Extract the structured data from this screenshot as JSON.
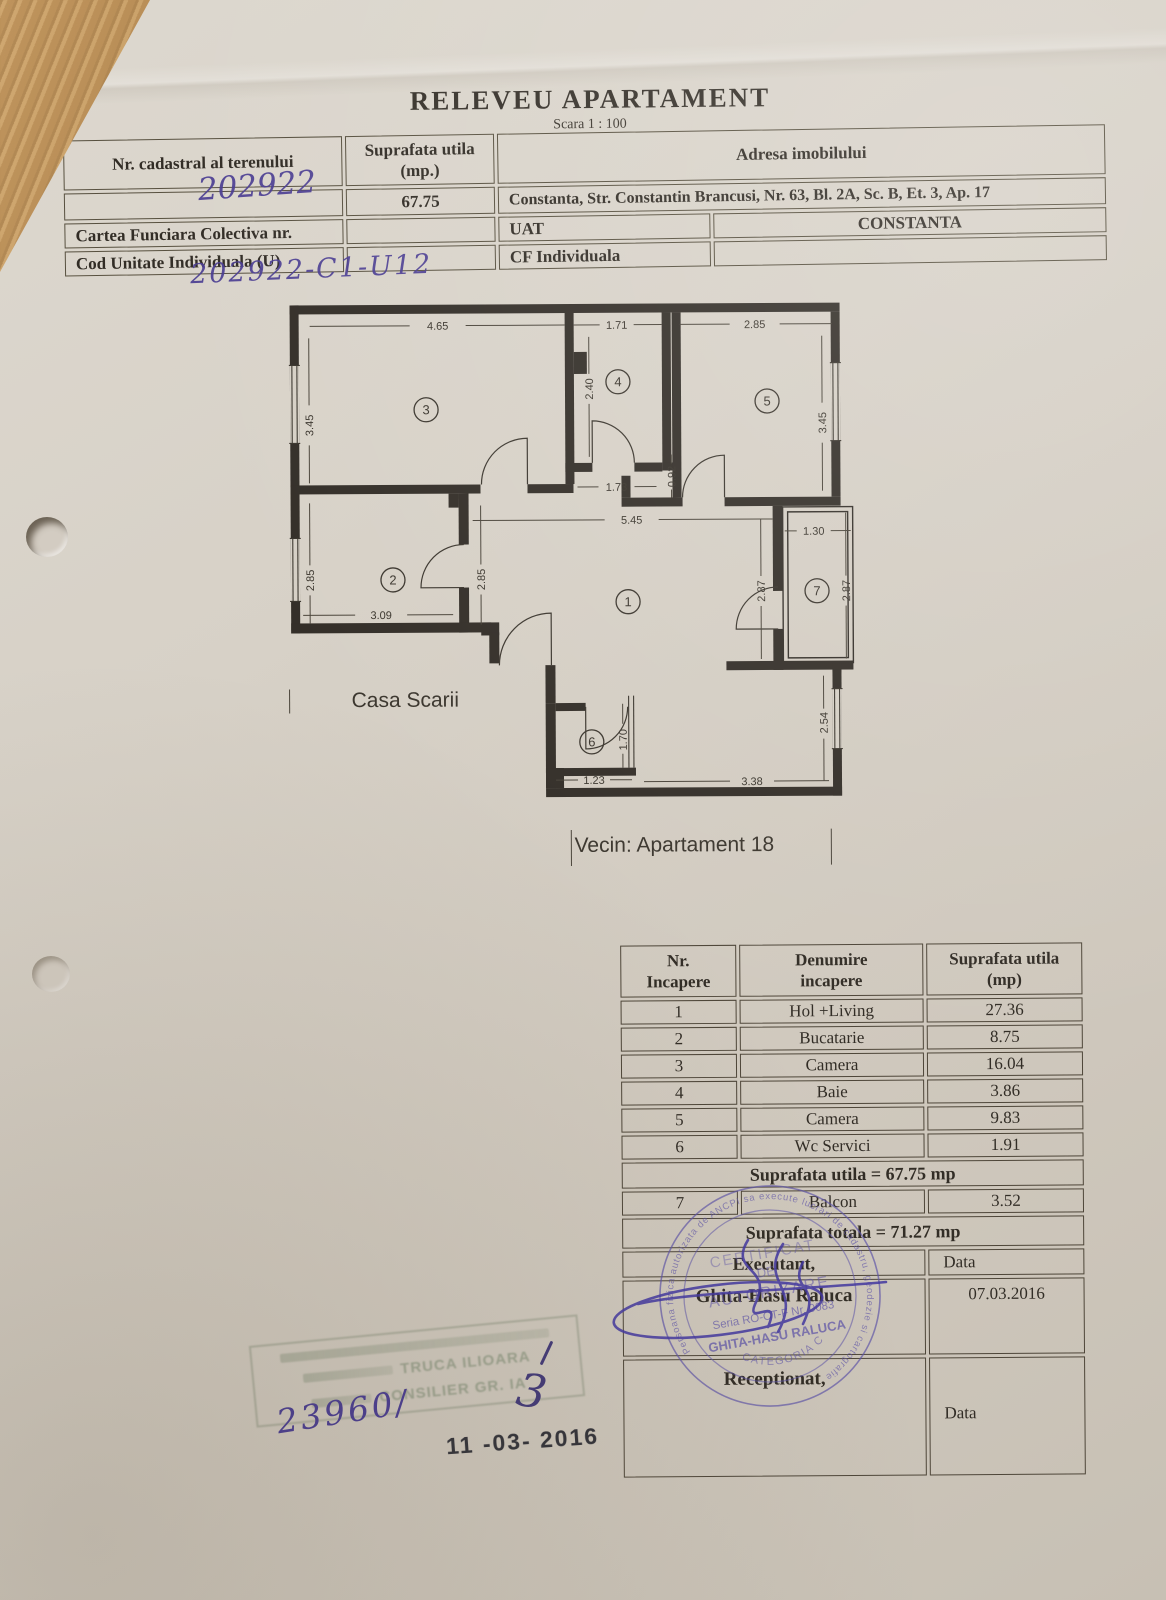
{
  "doc": {
    "title": "RELEVEU APARTAMENT",
    "scale": "Scara 1 : 100"
  },
  "header_table": {
    "col1_label": "Nr. cadastral al terenului",
    "col2_label": "Suprafata utila\n(mp.)",
    "col3_label": "Adresa imobilului",
    "cadastral_value": "202922",
    "suprafata_value": "67.75",
    "adresa_value": "Constanta, Str. Constantin Brancusi, Nr. 63, Bl. 2A, Sc. B, Et. 3, Ap. 17",
    "cartea_label": "Cartea Funciara Colectiva nr.",
    "uat_label": "UAT",
    "uat_value": "CONSTANTA",
    "cod_label": "Cod Unitate Individuala (U)",
    "cf_label": "CF Individuala",
    "unit_code_handwritten": "202922-C1-U12"
  },
  "floorplan": {
    "room_numbers": [
      "1",
      "2",
      "3",
      "4",
      "5",
      "6",
      "7"
    ],
    "dims": {
      "room3_w": "4.65",
      "room4_w": "1.71",
      "room5_w": "2.85",
      "room3_h": "3.45",
      "room4_h": "2.40",
      "room5_h": "3.45",
      "pass_w": "1.73",
      "pass_h": "0.92",
      "hall_w": "5.45",
      "kitchen_h": "2.85",
      "kitchen_door_h": "2.85",
      "kitchen_w": "3.09",
      "balcony_w": "1.30",
      "balcony_h1": "2.87",
      "balcony_h2": "2.87",
      "side_h": "2.54",
      "wc_w": "1.23",
      "wc_h": "1.70",
      "bottom_w": "3.38"
    },
    "labels": {
      "stairwell": "Casa Scarii",
      "neighbor": "Vecin: Apartament 18"
    }
  },
  "room_table": {
    "h_nr": "Nr.\nIncapere",
    "h_name": "Denumire\nincapere",
    "h_area": "Suprafata utila\n(mp)",
    "rows": [
      {
        "nr": "1",
        "name": "Hol +Living",
        "area": "27.36"
      },
      {
        "nr": "2",
        "name": "Bucatarie",
        "area": "8.75"
      },
      {
        "nr": "3",
        "name": "Camera",
        "area": "16.04"
      },
      {
        "nr": "4",
        "name": "Baie",
        "area": "3.86"
      },
      {
        "nr": "5",
        "name": "Camera",
        "area": "9.83"
      },
      {
        "nr": "6",
        "name": "Wc Servici",
        "area": "1.91"
      }
    ],
    "subtotal": "Suprafata utila =  67.75 mp",
    "balcony_row": {
      "nr": "7",
      "name": "Balcon",
      "area": "3.52"
    },
    "total": "Suprafata totala = 71.27 mp",
    "executant_label": "Executant,",
    "date_label": "Data",
    "executant_name": "Ghita-Hasu Raluca",
    "date_value": "07.03.2016",
    "receptionat_label": "Receptionat,",
    "date_label_2": "Data"
  },
  "stamps": {
    "round": {
      "ring_text": "Persoana fizica autorizata de ANCPI sa execute lucrari de cadastru, geodezie si cartografie",
      "line1": "CERTIFICAT",
      "line2": "DE",
      "line3": "AUTORIZARE",
      "line4": "Seria RO-CT-F Nr. 0083",
      "line5": "GHITA-HASU RALUCA",
      "line6": "CATEGORIA C"
    },
    "faded": {
      "name": "TRUCA ILIOARA",
      "title": "CONSILIER GR. IA"
    },
    "registry_number": "23960/",
    "date_stamp": "11 -03- 2016",
    "annotation_mark": "3"
  }
}
